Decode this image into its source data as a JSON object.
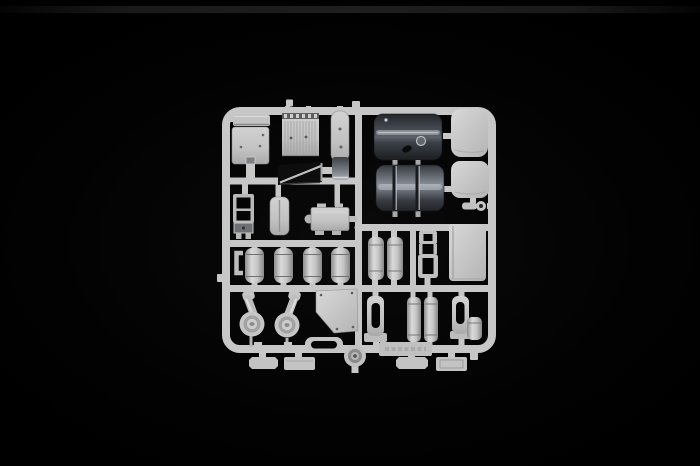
{
  "scene": {
    "description": "Photograph of an injection-molded plastic model kit sprue (runner frame) with light grey truck parts on a black background",
    "background_color": "#010101",
    "highlight_band_color": "#222222"
  },
  "colors": {
    "plastic_light": "#c7c7c7",
    "plastic_bright": "#d6d6d6",
    "plastic_mid": "#a8a8a8",
    "plastic_shadow": "#6e6e6e",
    "tank_dark": "#2b2e33",
    "tank_highlight": "#989ea6",
    "hole_black": "#050505"
  },
  "sprue": {
    "frame_name": "square runner frame with rounded corners",
    "parts": [
      {
        "id": "sun-visor",
        "name": "sun visor bar"
      },
      {
        "id": "floor-panel",
        "name": "flat panel with rivet holes"
      },
      {
        "id": "grille-panel",
        "name": "ribbed grille panel"
      },
      {
        "id": "narrow-plate",
        "name": "narrow rounded plate"
      },
      {
        "id": "curved-shell",
        "name": "curved metallic shell"
      },
      {
        "id": "angled-panel",
        "name": "angled dark panel"
      },
      {
        "id": "ladder-bracket",
        "name": "ladder bracket frame"
      },
      {
        "id": "cushion-panel",
        "name": "rounded cushion panel"
      },
      {
        "id": "gearbox-cover",
        "name": "gearbox cover with lugs"
      },
      {
        "id": "clip-bracket",
        "name": "C-shaped clip"
      },
      {
        "id": "air-tank-1",
        "name": "air tank cylinder 1"
      },
      {
        "id": "air-tank-2",
        "name": "air tank cylinder 2"
      },
      {
        "id": "air-tank-3",
        "name": "air tank cylinder 3"
      },
      {
        "id": "air-tank-4",
        "name": "air tank cylinder 4"
      },
      {
        "id": "fuel-tank-upper",
        "name": "large dark fuel tank"
      },
      {
        "id": "fuel-tank-lower",
        "name": "large fuel tank with straps"
      },
      {
        "id": "corner-panel-1",
        "name": "rounded corner panel 1"
      },
      {
        "id": "corner-panel-2",
        "name": "rounded corner panel 2"
      },
      {
        "id": "tow-hook",
        "name": "small tow hook"
      },
      {
        "id": "twin-tank-1",
        "name": "vertical tank 1"
      },
      {
        "id": "twin-tank-2",
        "name": "vertical tank 2"
      },
      {
        "id": "open-bracket",
        "name": "open bracket frame"
      },
      {
        "id": "flat-panel-large",
        "name": "large flat panel"
      },
      {
        "id": "air-cleaner-1",
        "name": "air cleaner with intake neck 1"
      },
      {
        "id": "air-cleaner-2",
        "name": "air cleaner with intake neck 2"
      },
      {
        "id": "chamfered-panel",
        "name": "chamfered flat panel"
      },
      {
        "id": "step-frame",
        "name": "oblong step frame"
      },
      {
        "id": "hub-disc",
        "name": "round hub disc"
      },
      {
        "id": "slotted-bracket-1",
        "name": "slotted bracket 1"
      },
      {
        "id": "small-tank-1",
        "name": "small cylinder tank 1"
      },
      {
        "id": "small-tank-2",
        "name": "small cylinder tank 2"
      },
      {
        "id": "slotted-bracket-2",
        "name": "slotted bracket 2"
      },
      {
        "id": "end-cylinder",
        "name": "short end cylinder"
      },
      {
        "id": "marking-plate",
        "name": "embossed marking plate"
      },
      {
        "id": "base-plate-1",
        "name": "small base plate 1"
      },
      {
        "id": "base-plate-2",
        "name": "small base plate 2"
      },
      {
        "id": "base-plate-3",
        "name": "small base plate 3"
      },
      {
        "id": "base-plate-4",
        "name": "small base plate 4"
      }
    ]
  }
}
